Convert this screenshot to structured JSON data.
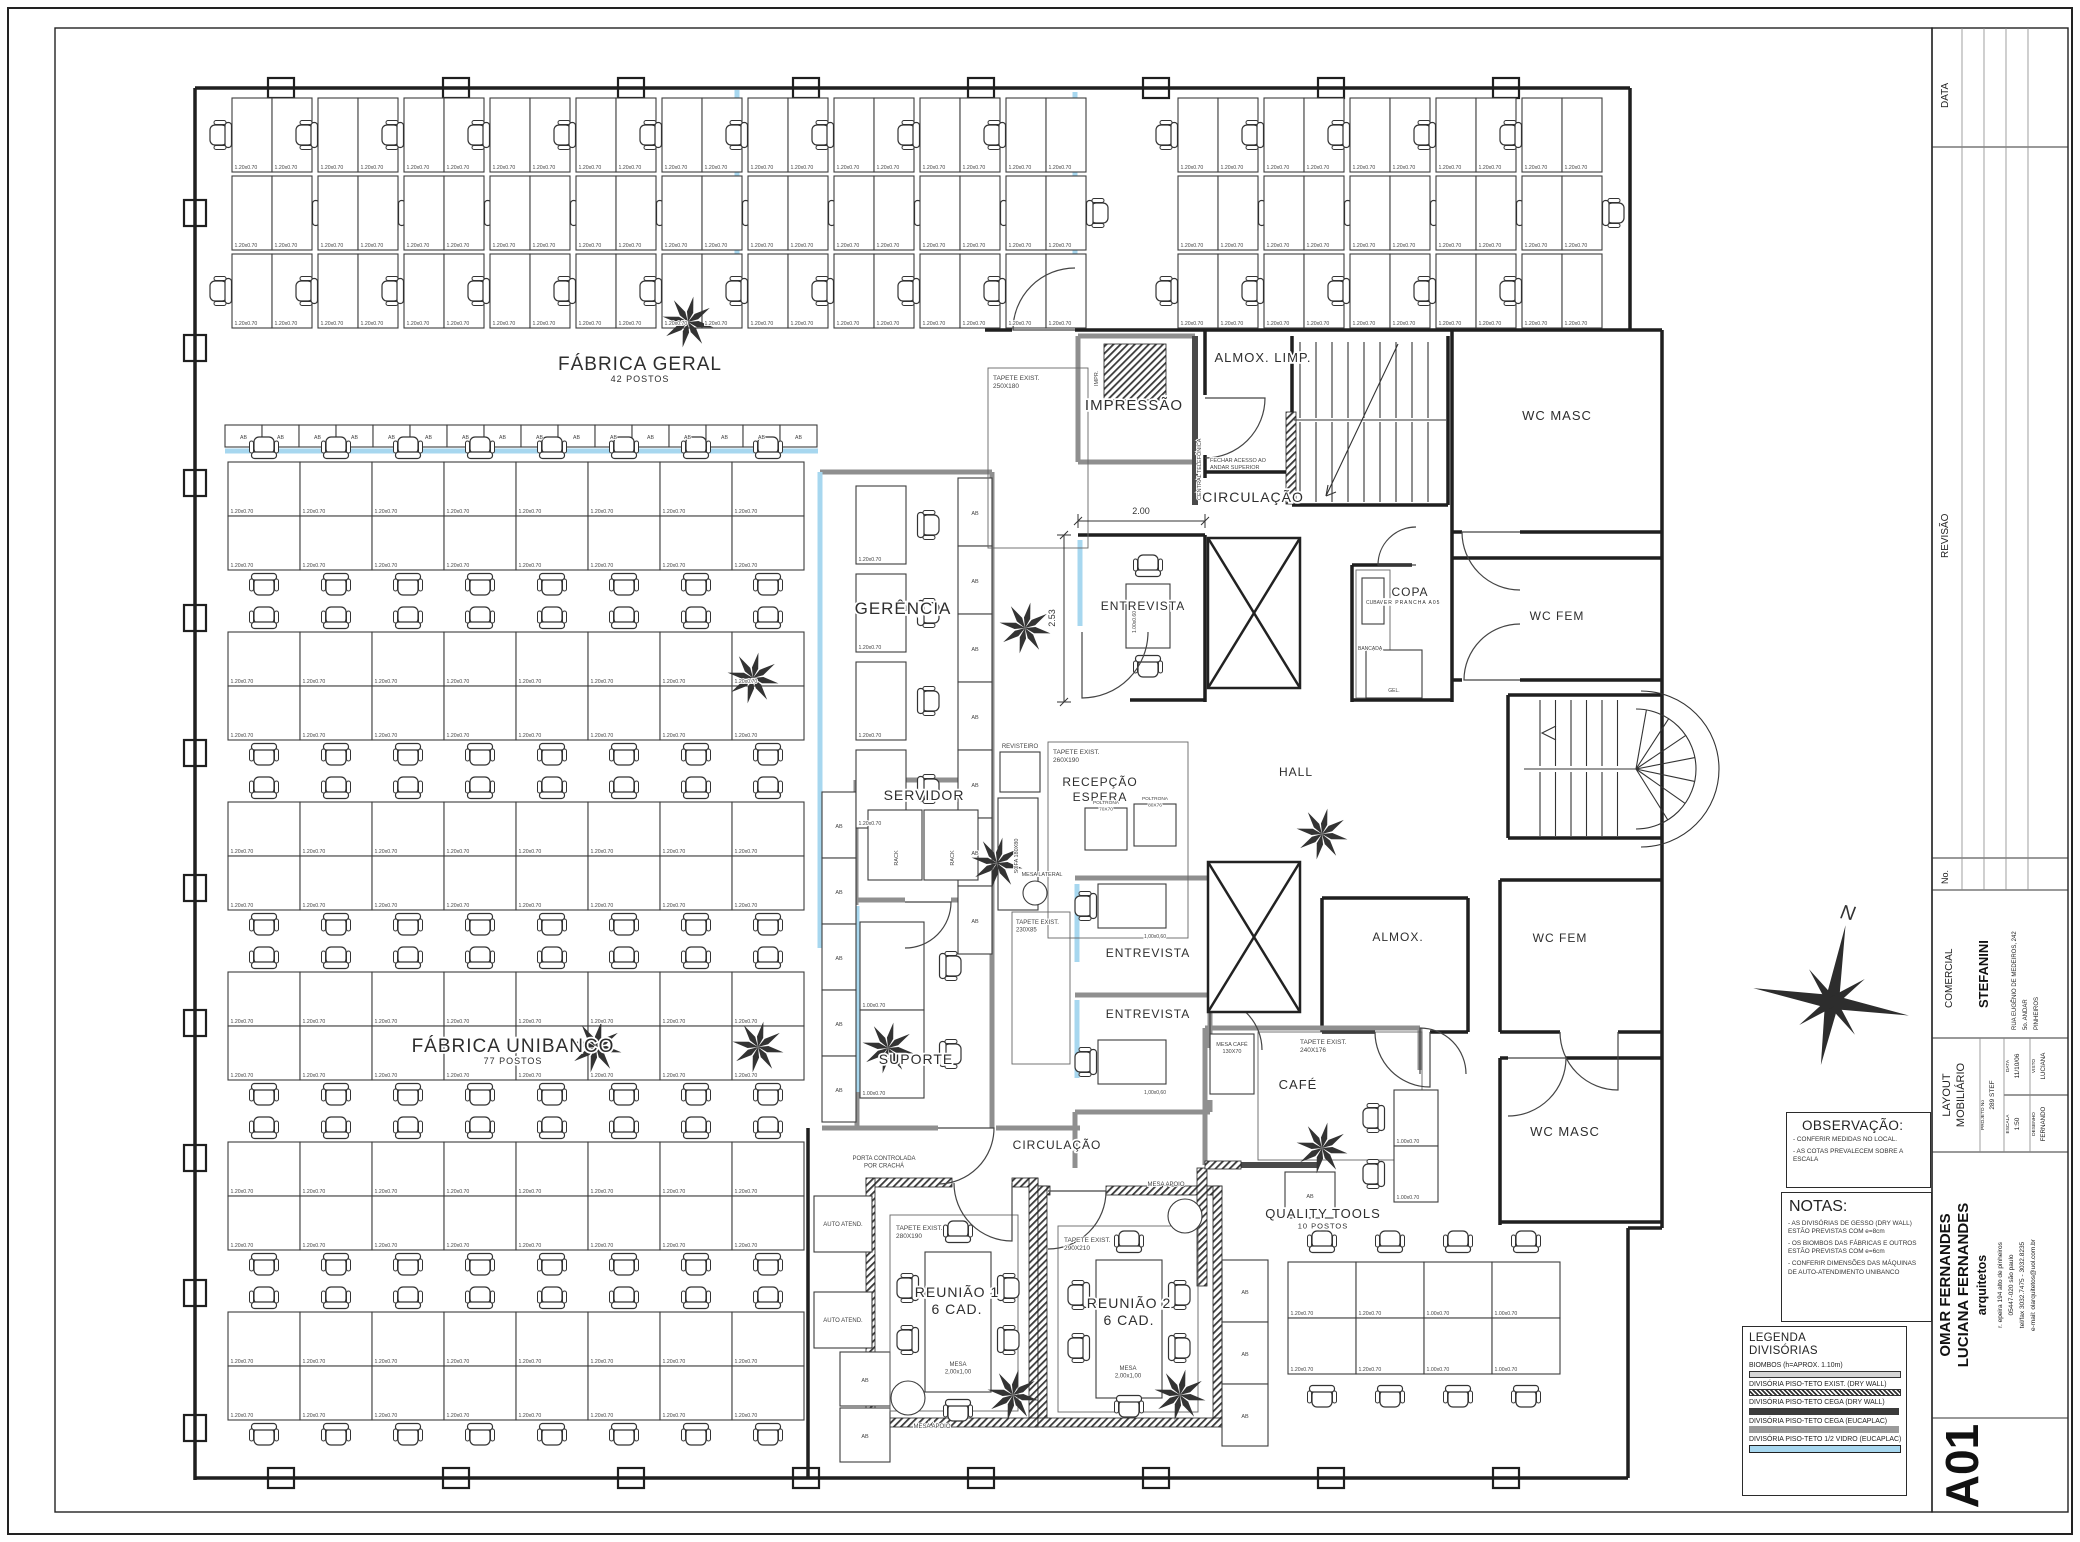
{
  "colors": {
    "paper": "#ffffff",
    "line": "#1f1f1f",
    "glass_blue": "#a7d7ef",
    "wall_gray": "#8f8f8f",
    "wall_dark": "#4a4a4a"
  },
  "title_strip": {
    "data_header": "DATA",
    "revisao_header": "REVISÃO",
    "no_header": "No.",
    "comercial_header": "COMERCIAL",
    "client": "STEFANINI",
    "client_address": [
      "RUA EUGÊNIO DE MEDEIROS, 242",
      "5o. ANDAR",
      "PINHEIROS"
    ],
    "project_title_1": "LAYOUT",
    "project_title_2": "MOBILIÁRIO",
    "projeto_label": "PROJETO No",
    "projeto_value": "289 STEF",
    "data_label": "DATA",
    "data_value": "11/10/06",
    "escala_label": "ESCALA",
    "escala_value": "1:50",
    "visto_label": "VISTO",
    "visto_value": "LUCIANA",
    "desenho_label": "DESENHO",
    "desenho_value": "FERNANDO",
    "firm_name_1": "OMAR FERNANDES",
    "firm_name_2": "LUCIANA FERNANDES",
    "firm_tag": "arquitetos",
    "firm_address": [
      "r. epeira 194  alto de pinheiros",
      "05447-020 são paulo",
      "tel/fax 3032.7475 - 3032.8235",
      "e-mail: olarquitetos@uol.com.br"
    ],
    "sheet_number": "A01"
  },
  "observacao": {
    "title": "OBSERVAÇÃO:",
    "items": [
      "- CONFERIR MEDIDAS NO LOCAL.",
      "- AS COTAS PREVALECEM SOBRE A ESCALA"
    ]
  },
  "notas": {
    "title": "NOTAS:",
    "items": [
      "- AS DIVISÓRIAS DE GESSO (DRY WALL) ESTÃO PREVISTAS COM e=8cm",
      "- OS BIOMBOS DAS FÁBRICAS E OUTROS ESTÃO PREVISTAS COM e=6cm",
      "- CONFERIR DIMENSÕES DAS MÁQUINAS DE AUTO-ATENDIMENTO UNIBANCO"
    ]
  },
  "legenda": {
    "title_1": "LEGENDA",
    "title_2": "DIVISÓRIAS",
    "items": [
      {
        "label": "BIOMBOS  (h=APROX. 1.10m)"
      },
      {
        "label": "DIVISÓRIA PISO-TETO EXIST. (DRY WALL)"
      },
      {
        "label": "DIVISÓRIA PISO-TETO CEGA (DRY WALL)"
      },
      {
        "label": "DIVISÓRIA PISO-TETO CEGA (EUCAPLAC)"
      },
      {
        "label": "DIVISÓRIA PISO-TETO 1/2 VIDRO (EUCAPLAC)"
      }
    ]
  },
  "compass_label": "N",
  "plan": {
    "furniture_labels": {
      "cabinet": "AB",
      "rack": "RACK",
      "desk_120": "1.20x0.70",
      "desk_100": "1.00x0.70",
      "desk_100_60": "1.00x0.60"
    },
    "rooms": [
      {
        "t": "FÁBRICA GERAL",
        "s": "42 POSTOS",
        "x": 640,
        "y": 370,
        "f": 19,
        "sf": 9
      },
      {
        "t": "FÁBRICA UNIBANCO",
        "s": "77 POSTOS",
        "x": 513,
        "y": 1052,
        "f": 19,
        "sf": 9
      },
      {
        "t": "GERÊNCIA",
        "x": 903,
        "y": 614,
        "f": 17
      },
      {
        "t": "SERVIDOR",
        "x": 924,
        "y": 800,
        "f": 14
      },
      {
        "t": "SUPORTE",
        "x": 916,
        "y": 1064,
        "f": 14
      },
      {
        "t": "IMPRESSÃO",
        "x": 1134,
        "y": 410,
        "f": 15
      },
      {
        "t": "ALMOX. LIMP.",
        "x": 1263,
        "y": 362,
        "f": 13
      },
      {
        "t": "CIRCULAÇÃO",
        "x": 1253,
        "y": 502,
        "f": 14
      },
      {
        "t": "CIRCULAÇÃO",
        "x": 1057,
        "y": 1149,
        "f": 12
      },
      {
        "t": "ENTREVISTA",
        "x": 1143,
        "y": 610,
        "f": 12
      },
      {
        "t": "ENTREVISTA",
        "x": 1148,
        "y": 957,
        "f": 12
      },
      {
        "t": "ENTREVISTA",
        "x": 1148,
        "y": 1018,
        "f": 12
      },
      {
        "t": "RECEPÇÃO",
        "s": "ESPERA",
        "x": 1100,
        "y": 786,
        "f": 12,
        "sf": 12
      },
      {
        "t": "HALL",
        "x": 1296,
        "y": 776,
        "f": 12
      },
      {
        "t": "COPA",
        "s": "VER PRANCHA A05",
        "x": 1410,
        "y": 596,
        "f": 12,
        "sf": 5
      },
      {
        "t": "WC MASC",
        "x": 1557,
        "y": 420,
        "f": 13
      },
      {
        "t": "WC FEM",
        "x": 1557,
        "y": 620,
        "f": 12
      },
      {
        "t": "WC FEM",
        "x": 1560,
        "y": 942,
        "f": 12
      },
      {
        "t": "WC MASC",
        "x": 1565,
        "y": 1136,
        "f": 13
      },
      {
        "t": "ALMOX.",
        "x": 1398,
        "y": 941,
        "f": 12
      },
      {
        "t": "CAFÉ",
        "x": 1298,
        "y": 1089,
        "f": 13
      },
      {
        "t": "QUALITY TOOLS",
        "s": "10 POSTOS",
        "x": 1323,
        "y": 1218,
        "f": 13,
        "sf": 7.5
      },
      {
        "t": "REUNIÃO 1",
        "s": "6 CAD.",
        "x": 957,
        "y": 1297,
        "f": 14,
        "sf": 14
      },
      {
        "t": "REUNIÃO 2",
        "s": "6 CAD.",
        "x": 1129,
        "y": 1308,
        "f": 14,
        "sf": 14
      }
    ],
    "annotations": [
      {
        "t": "TAPETE EXIST.\n250X180",
        "x": 993,
        "y": 380,
        "f": 6.5,
        "a": "start"
      },
      {
        "t": "TAPETE EXIST.\n260X190",
        "x": 1053,
        "y": 754,
        "f": 6.5,
        "a": "start"
      },
      {
        "t": "TAPETE EXIST.\n230X85",
        "x": 1016,
        "y": 924,
        "f": 6,
        "a": "start"
      },
      {
        "t": "TAPETE EXIST.\n240X176",
        "x": 1300,
        "y": 1044,
        "f": 6.5,
        "a": "start"
      },
      {
        "t": "TAPETE EXIST.\n280X190",
        "x": 896,
        "y": 1230,
        "f": 6.5,
        "a": "start"
      },
      {
        "t": "TAPETE EXIST.\n290X210",
        "x": 1064,
        "y": 1242,
        "f": 6.5,
        "a": "start"
      },
      {
        "t": "REVISTEIRO",
        "x": 1020,
        "y": 748,
        "f": 6
      },
      {
        "t": "SOFA 180X80",
        "x": 1018,
        "y": 856,
        "f": 5.5,
        "r": -90
      },
      {
        "t": "POLTRONA\n70X70",
        "x": 1106,
        "y": 804,
        "f": 4.8
      },
      {
        "t": "POLTRONA\n80X76",
        "x": 1155,
        "y": 800,
        "f": 4.8
      },
      {
        "t": "MESA LATERAL",
        "x": 1042,
        "y": 876,
        "f": 5.5
      },
      {
        "t": "MESA CAFÉ\n130X70",
        "x": 1232,
        "y": 1046,
        "f": 5.5
      },
      {
        "t": "MESA APOIO",
        "x": 932,
        "y": 1428,
        "f": 6
      },
      {
        "t": "MESA APOIO",
        "x": 1166,
        "y": 1186,
        "f": 6
      },
      {
        "t": "MESA\n2,00x1,00",
        "x": 958,
        "y": 1366,
        "f": 6
      },
      {
        "t": "MESA\n2,00x1,00",
        "x": 1128,
        "y": 1370,
        "f": 6
      },
      {
        "t": "AUTO ATEND.",
        "x": 843,
        "y": 1226,
        "f": 6
      },
      {
        "t": "AUTO ATEND.",
        "x": 843,
        "y": 1322,
        "f": 6
      },
      {
        "t": "PORTA CONTROLADA\nPOR CRACHÁ",
        "x": 884,
        "y": 1160,
        "f": 6
      },
      {
        "t": "FECHAR ACESSO AO\nANDAR SUPERIOR",
        "x": 1210,
        "y": 462,
        "f": 5.5,
        "a": "start"
      },
      {
        "t": "CENTRAL TELEFÔNICA",
        "x": 1201,
        "y": 500,
        "f": 5.5,
        "a": "start",
        "r": -90
      },
      {
        "t": "IMPR.",
        "x": 1098,
        "y": 386,
        "f": 5.5,
        "a": "start",
        "r": -90
      },
      {
        "t": "CUBA",
        "x": 1373,
        "y": 604,
        "f": 5
      },
      {
        "t": "BANCADA",
        "x": 1358,
        "y": 650,
        "f": 5,
        "a": "start"
      },
      {
        "t": "GEL.",
        "x": 1394,
        "y": 692,
        "f": 5
      },
      {
        "t": "RACK",
        "x": 898,
        "y": 858,
        "f": 5.5,
        "r": -90
      },
      {
        "t": "RACK",
        "x": 954,
        "y": 858,
        "f": 5.5,
        "r": -90
      },
      {
        "t": "1.00x0.60",
        "x": 1136,
        "y": 622,
        "f": 5,
        "r": -90
      },
      {
        "t": "1,00x0,60",
        "x": 1166,
        "y": 938,
        "f": 5,
        "a": "end"
      },
      {
        "t": "1,00x0,60",
        "x": 1166,
        "y": 1094,
        "f": 5,
        "a": "end"
      }
    ],
    "dimensions": [
      {
        "t": "2.00",
        "x": 1141,
        "y": 514
      },
      {
        "t": "2.53",
        "x": 1055,
        "y": 618,
        "r": -90
      }
    ]
  }
}
